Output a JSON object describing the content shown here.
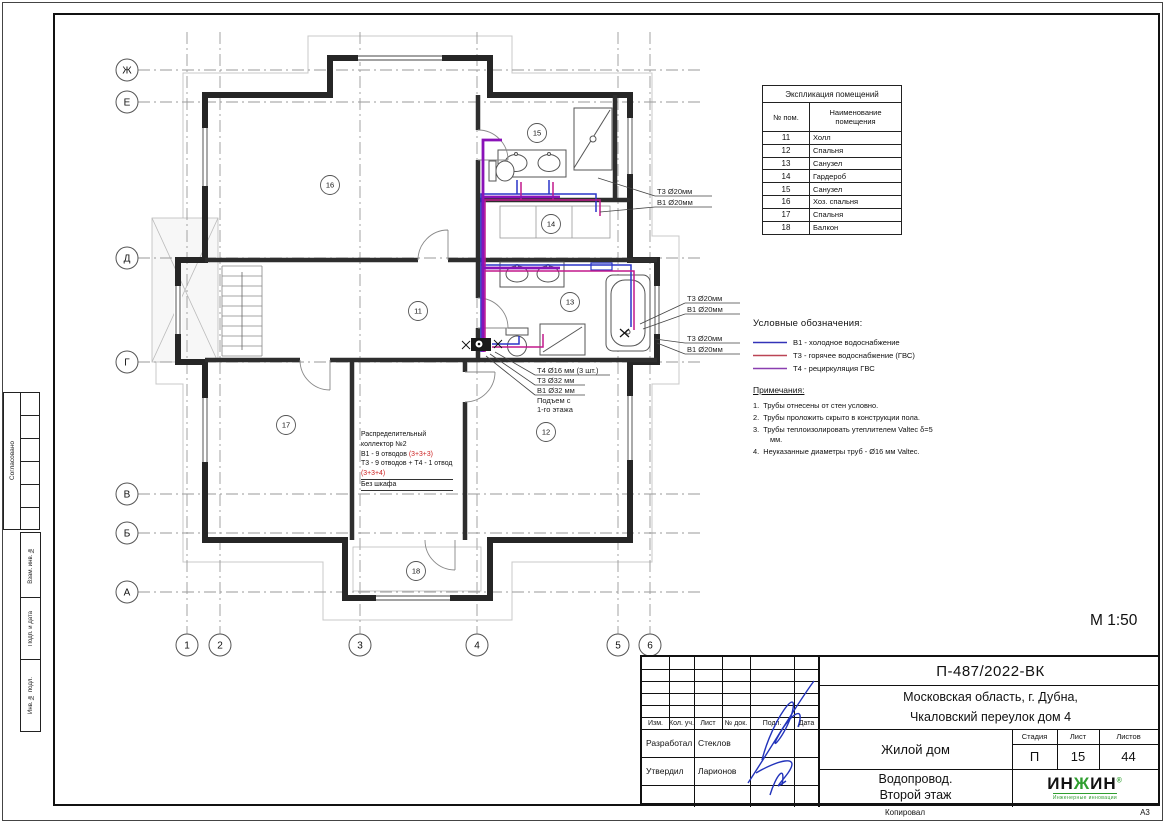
{
  "scale": "М 1:50",
  "footer": {
    "copied": "Копировал",
    "format": "А3"
  },
  "sidebar": {
    "agreed": "Согласовано",
    "subst": "Взам. инв. №",
    "sign": "Подп. и дата",
    "inv": "Инв. № подл."
  },
  "axes": {
    "rows": [
      "Ж",
      "Е",
      "Д",
      "Г",
      "В",
      "Б",
      "А"
    ],
    "cols": [
      "1",
      "2",
      "3",
      "4",
      "5",
      "6"
    ]
  },
  "rooms": [
    "16",
    "15",
    "14",
    "11",
    "13",
    "17",
    "12",
    "18"
  ],
  "plan_colors": {
    "t4": "#8a12b8",
    "t3": "#c2188c",
    "b1": "#2a35c8"
  },
  "annotations": {
    "a1": [
      "Т3 Ø20мм",
      "В1 Ø20мм"
    ],
    "a2": [
      "Т3 Ø20мм",
      "В1 Ø20мм"
    ],
    "a3": [
      "Т3 Ø20мм",
      "В1 Ø20мм"
    ],
    "riser": [
      "Т4 Ø16 мм (3 шт.)",
      "Т3 Ø32 мм",
      "В1 Ø32 мм",
      "Подъем с",
      "1-го этажа"
    ]
  },
  "collector_note": {
    "l1": "Распределительный",
    "l2": "коллектор №2",
    "l3a": "В1 - 9 отводов ",
    "l3b": "(3+3+3)",
    "l4": "Т3 - 9 отводов + Т4 - 1 отвод",
    "l5": "(3+3+4)",
    "l6": "Без шкафа"
  },
  "explication": {
    "title": "Экспликация помещений",
    "col_num": "№ пом.",
    "col_name": "Наименование помещения",
    "rows": [
      {
        "num": "11",
        "name": "Холл"
      },
      {
        "num": "12",
        "name": "Спальня"
      },
      {
        "num": "13",
        "name": "Санузел"
      },
      {
        "num": "14",
        "name": "Гардероб"
      },
      {
        "num": "15",
        "name": "Санузел"
      },
      {
        "num": "16",
        "name": "Хоз. спальня"
      },
      {
        "num": "17",
        "name": "Спальня"
      },
      {
        "num": "18",
        "name": "Балкон"
      }
    ]
  },
  "legend": {
    "title": "Условные обозначения:",
    "items": [
      {
        "label": "В1 - холодное водоснабжение",
        "color": "#3333b8"
      },
      {
        "label": "Т3 - горячее водоснабжение (ГВС)",
        "color": "#bb4455"
      },
      {
        "label": "Т4 - рециркуляция ГВС",
        "color": "#8a3fb0"
      }
    ]
  },
  "notes": {
    "title": "Примечания:",
    "items": [
      "1.  Трубы отнесены от стен условно.",
      "2.  Трубы проложить скрыто в конструкции пола.",
      "3.  Трубы теплоизолировать утеплителем Valtec δ=5 мм.",
      "4.  Неуказанные диаметры труб - Ø16 мм Valtec."
    ]
  },
  "titleblock": {
    "doc_code": "П-487/2022-ВК",
    "address1": "Московская область, г. Дубна,",
    "address2": "Чкаловский переулок дом 4",
    "object_name": "Жилой дом",
    "drawing1": "Водопровод.",
    "drawing2": "Второй этаж",
    "stage_label": "Стадия",
    "sheet_label": "Лист",
    "sheets_label": "Листов",
    "stage": "П",
    "sheet_no": "15",
    "sheets_total": "44",
    "header": [
      "Изм.",
      "Кол. уч.",
      "Лист",
      "№ док.",
      "Подп.",
      "Дата"
    ],
    "rows": [
      {
        "role": "Разработал",
        "name": "Стеклов"
      },
      {
        "role": "Утвердил",
        "name": "Ларионов"
      }
    ]
  },
  "logo": {
    "part1": "ИН",
    "part2": "Ж",
    "part3": "ИН",
    "reg": "®",
    "tagline": "Инженерные инновации"
  }
}
